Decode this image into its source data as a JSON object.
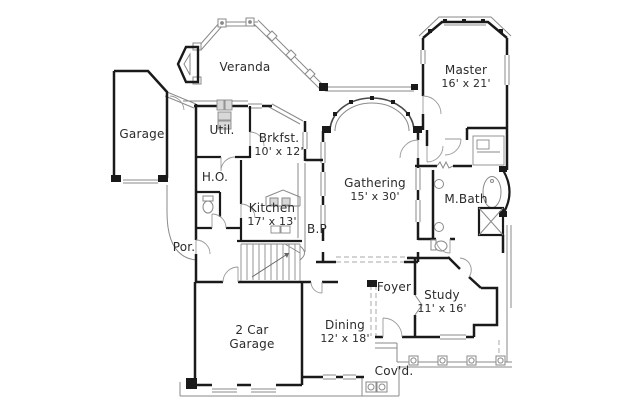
{
  "plan": {
    "type": "floor-plan",
    "background": "#ffffff",
    "colors": {
      "wall": "#1a1a1a",
      "thin": "#8a8a8a",
      "dashed": "#a8a8a8",
      "text": "#2b2b2b"
    },
    "rooms": [
      {
        "label": "Veranda",
        "sublabel": "",
        "x": 245,
        "y": 68
      },
      {
        "label": "Master",
        "sublabel": "16' x 21'",
        "x": 466,
        "y": 71
      },
      {
        "label": "Garage",
        "sublabel": "",
        "x": 142,
        "y": 135
      },
      {
        "label": "Util.",
        "sublabel": "",
        "x": 222,
        "y": 131
      },
      {
        "label": "Brkfst.",
        "sublabel": "10' x 12'",
        "x": 279,
        "y": 139
      },
      {
        "label": "H.O.",
        "sublabel": "",
        "x": 215,
        "y": 178
      },
      {
        "label": "Gathering",
        "sublabel": "15' x 30'",
        "x": 375,
        "y": 184
      },
      {
        "label": "M.Bath",
        "sublabel": "",
        "x": 466,
        "y": 200
      },
      {
        "label": "Kitchen",
        "sublabel": "17' x 13'",
        "x": 272,
        "y": 209
      },
      {
        "label": "B.P",
        "sublabel": "",
        "x": 317,
        "y": 230
      },
      {
        "label": "Por.",
        "sublabel": "",
        "x": 184,
        "y": 248
      },
      {
        "label": "Foyer",
        "sublabel": "",
        "x": 394,
        "y": 288
      },
      {
        "label": "Study",
        "sublabel": "11' x 16'",
        "x": 442,
        "y": 296
      },
      {
        "label": "2 Car",
        "sublabel": "Garage",
        "x": 252,
        "y": 331
      },
      {
        "label": "Dining",
        "sublabel": "12' x 18'",
        "x": 345,
        "y": 326
      },
      {
        "label": "Cov'd.",
        "sublabel": "",
        "x": 394,
        "y": 372
      }
    ],
    "icons": [
      "stairs-icon",
      "bathtub-icon",
      "toilet-icon",
      "sink-icon",
      "fireplace-icon",
      "column-icon",
      "door-swing-icon",
      "range-hood-icon",
      "washer-dryer-icon",
      "arch-window-icon"
    ]
  }
}
